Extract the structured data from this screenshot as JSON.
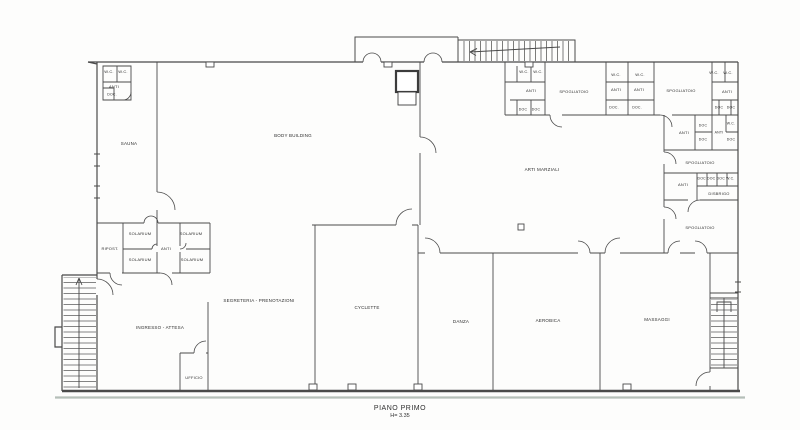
{
  "plan": {
    "type": "floor-plan",
    "title": {
      "line1": "PIANO PRIMO",
      "line2": "H= 3.35"
    },
    "colors": {
      "line": "#4a4a4a",
      "scan_band": "#a9b5ad",
      "background": "#fdfdfc",
      "text": "#2e2e2e"
    },
    "labels": [
      {
        "name": "wc-topleft-1",
        "label": "W.C.",
        "x": 109,
        "y": 72,
        "fs": 4
      },
      {
        "name": "wc-topleft-2",
        "label": "W.C.",
        "x": 123,
        "y": 72,
        "fs": 4
      },
      {
        "name": "anti-topleft",
        "label": "ANTI",
        "x": 114,
        "y": 87,
        "fs": 4
      },
      {
        "name": "doc-topleft",
        "label": "DOC.",
        "x": 112,
        "y": 95,
        "fs": 3.5
      },
      {
        "name": "sauna",
        "label": "SAUNA",
        "x": 129,
        "y": 144,
        "fs": 4.5
      },
      {
        "name": "body-building",
        "label": "BODY BUILDING",
        "x": 293,
        "y": 136,
        "fs": 4.5
      },
      {
        "name": "ripost",
        "label": "RIPOST.",
        "x": 110,
        "y": 249,
        "fs": 4
      },
      {
        "name": "solarium-1",
        "label": "SOLARIUM",
        "x": 140,
        "y": 234,
        "fs": 4
      },
      {
        "name": "solarium-2",
        "label": "SOLARIUM",
        "x": 140,
        "y": 260,
        "fs": 4
      },
      {
        "name": "solarium-3",
        "label": "SOLARIUM",
        "x": 191,
        "y": 234,
        "fs": 4
      },
      {
        "name": "solarium-4",
        "label": "SOLARIUM",
        "x": 192,
        "y": 260,
        "fs": 4
      },
      {
        "name": "anti-solarium",
        "label": "ANTI",
        "x": 166,
        "y": 249,
        "fs": 4
      },
      {
        "name": "segreteria",
        "label": "SEGRETERIA - PRENOTAZIONI",
        "x": 259,
        "y": 301,
        "fs": 4.5
      },
      {
        "name": "ingresso",
        "label": "INGRESSO - ATTESA",
        "x": 160,
        "y": 328,
        "fs": 4.5
      },
      {
        "name": "ufficio",
        "label": "UFFICIO",
        "x": 194,
        "y": 378,
        "fs": 4
      },
      {
        "name": "cyclette",
        "label": "CYCLETTE",
        "x": 367,
        "y": 308,
        "fs": 4.5
      },
      {
        "name": "danza",
        "label": "DANZA",
        "x": 461,
        "y": 322,
        "fs": 4.5
      },
      {
        "name": "aerobica",
        "label": "AEROBICA",
        "x": 548,
        "y": 321,
        "fs": 4.5
      },
      {
        "name": "massaggi",
        "label": "MASSAGGI",
        "x": 657,
        "y": 320,
        "fs": 4.5
      },
      {
        "name": "arti-marziali",
        "label": "ARTI MARZIALI",
        "x": 542,
        "y": 170,
        "fs": 4.5
      },
      {
        "name": "wc-c1-1",
        "label": "W.C.",
        "x": 524,
        "y": 72,
        "fs": 4
      },
      {
        "name": "wc-c1-2",
        "label": "W.C.",
        "x": 538,
        "y": 72,
        "fs": 4
      },
      {
        "name": "anti-c1",
        "label": "ANTI",
        "x": 531,
        "y": 91,
        "fs": 4
      },
      {
        "name": "doc-c1-1",
        "label": "DOC",
        "x": 523,
        "y": 110,
        "fs": 3.5
      },
      {
        "name": "doc-c1-2",
        "label": "DOC",
        "x": 536,
        "y": 110,
        "fs": 3.5
      },
      {
        "name": "spogliatoio-1",
        "label": "SPOGLIATOIO",
        "x": 574,
        "y": 92,
        "fs": 4
      },
      {
        "name": "wc-c2",
        "label": "W.C.",
        "x": 616,
        "y": 75,
        "fs": 4
      },
      {
        "name": "anti-c2",
        "label": "ANTI",
        "x": 616,
        "y": 90,
        "fs": 4
      },
      {
        "name": "doc-c2",
        "label": "DOC.",
        "x": 614,
        "y": 108,
        "fs": 3.5
      },
      {
        "name": "wc-c3",
        "label": "W.C.",
        "x": 640,
        "y": 75,
        "fs": 4
      },
      {
        "name": "anti-c3",
        "label": "ANTI",
        "x": 639,
        "y": 90,
        "fs": 4
      },
      {
        "name": "doc-c3",
        "label": "DOC.",
        "x": 637,
        "y": 108,
        "fs": 3.5
      },
      {
        "name": "spogliatoio-2",
        "label": "SPOGLIATOIO",
        "x": 681,
        "y": 91,
        "fs": 4
      },
      {
        "name": "wc-c4-1",
        "label": "W.C.",
        "x": 714,
        "y": 73,
        "fs": 4
      },
      {
        "name": "wc-c4-2",
        "label": "W.C.",
        "x": 728,
        "y": 73,
        "fs": 4
      },
      {
        "name": "anti-c4",
        "label": "ANTI",
        "x": 727,
        "y": 92,
        "fs": 4
      },
      {
        "name": "doc-c4-1",
        "label": "DOC",
        "x": 719,
        "y": 108,
        "fs": 3.5
      },
      {
        "name": "doc-c4-2",
        "label": "DOC",
        "x": 731,
        "y": 108,
        "fs": 3.5
      },
      {
        "name": "anti-r1",
        "label": "ANTI",
        "x": 684,
        "y": 133,
        "fs": 4
      },
      {
        "name": "doc-r1-1",
        "label": "DOC",
        "x": 703,
        "y": 126,
        "fs": 3.5
      },
      {
        "name": "doc-r1-2",
        "label": "DOC",
        "x": 703,
        "y": 140,
        "fs": 3.5
      },
      {
        "name": "anti-r1-2",
        "label": "ANTI",
        "x": 719,
        "y": 133,
        "fs": 3.5
      },
      {
        "name": "wc-r1",
        "label": "W.C.",
        "x": 731,
        "y": 124,
        "fs": 3.5
      },
      {
        "name": "doc-r1-3",
        "label": "DOC",
        "x": 731,
        "y": 140,
        "fs": 3.5
      },
      {
        "name": "spogliatoio-3",
        "label": "SPOGLIATOIO",
        "x": 700,
        "y": 163,
        "fs": 4
      },
      {
        "name": "anti-r2",
        "label": "ANTI",
        "x": 683,
        "y": 185,
        "fs": 4
      },
      {
        "name": "doc-stalls-r2",
        "label": "DOC DOC DOC W.C.",
        "x": 716,
        "y": 179,
        "fs": 3.5
      },
      {
        "name": "disbrigo",
        "label": "DISBRIGO",
        "x": 719,
        "y": 194,
        "fs": 4
      },
      {
        "name": "spogliatoio-4",
        "label": "SPOGLIATOIO",
        "x": 700,
        "y": 228,
        "fs": 4
      }
    ]
  }
}
